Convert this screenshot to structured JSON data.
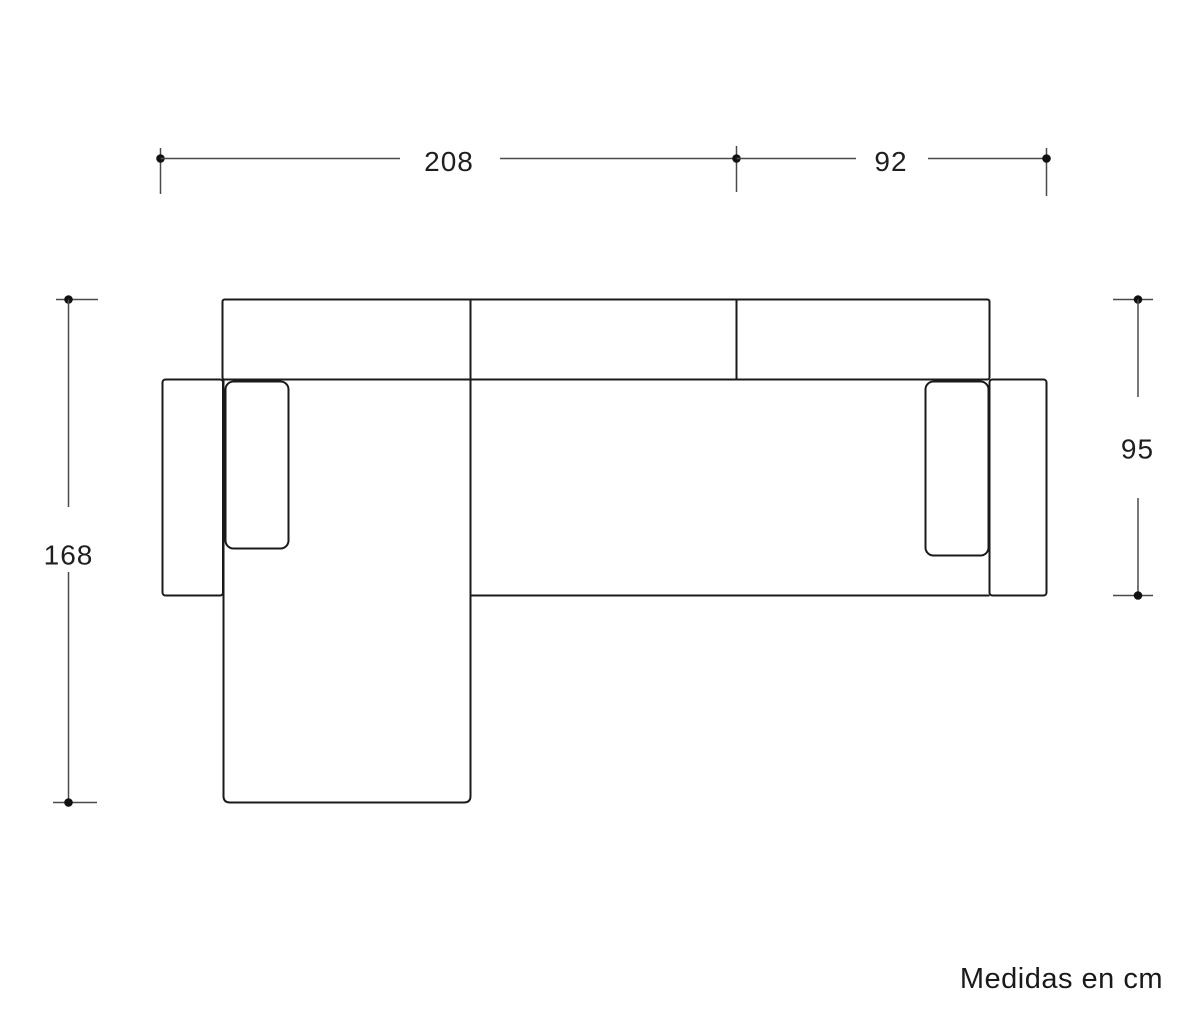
{
  "note": "Medidas en cm",
  "diagram": {
    "units": "cm",
    "colors": {
      "background": "#ffffff",
      "outline": "#1a1a1a",
      "dimension_line": "#4a4a4a",
      "text": "#1f1f1f"
    },
    "dimensions": {
      "width_left_section": "208",
      "width_right_section": "92",
      "depth_with_chaise": "168",
      "depth_sofa": "95"
    }
  }
}
